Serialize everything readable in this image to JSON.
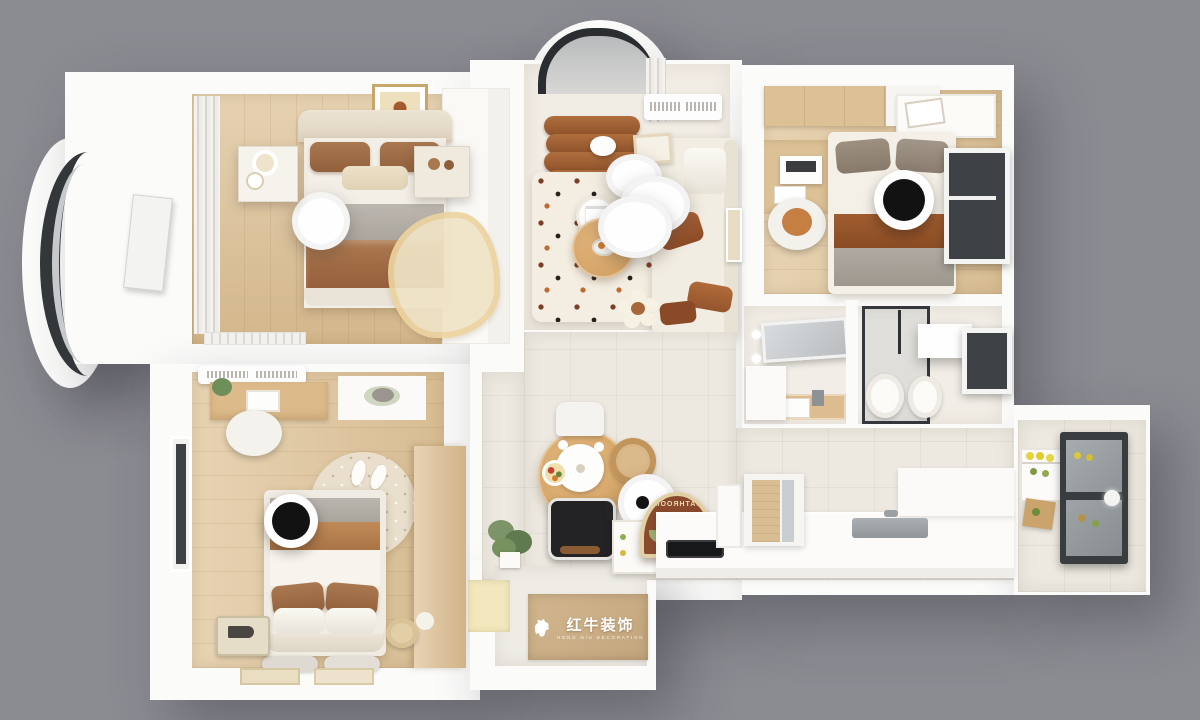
{
  "scene": {
    "type": "3d-apartment-floorplan-top-view",
    "background_color": "#8b8b92",
    "wall_color": "#fbfbfa"
  },
  "watermark": {
    "brand_cn": "红牛装饰",
    "brand_en": "HONG NIU DECORATION"
  },
  "bathroom_rug": {
    "text": "BATHROOM",
    "style": "mirrored arched rug with tulip motif",
    "colors": {
      "base": "#8a4a2e",
      "trim": "#e3cfa4",
      "tulip": "#e7c95e",
      "leaves": "#9aaa70"
    }
  },
  "palette": {
    "wood_floor": "#ddc298",
    "tile_floor": "#ede9e1",
    "living_floor": "#f1ece4",
    "sofa_cream": "#f2ede2",
    "armchair_brown": "#a05f34",
    "duvet_brown": "#a26e48",
    "runner_brown": "#96552c",
    "table_wood": "#d9a86c",
    "dark_frame": "#3a3d40",
    "lamp_black": "#151515"
  },
  "rooms": [
    {
      "name": "master-bedroom",
      "floor": "wood",
      "furniture": [
        "double-bed",
        "brown-pillows",
        "ceiling-lamp",
        "nightstand-left",
        "nightstand-right",
        "window-curtains",
        "ornate-accent-rug",
        "organic-bedside-rug",
        "radiator",
        "closet"
      ]
    },
    {
      "name": "bay-balcony",
      "floor": "white",
      "furniture": [
        "curved-glass-window",
        "leaning-board"
      ]
    },
    {
      "name": "living-room",
      "floor": "cream",
      "furniture": [
        "arched-bay-window",
        "sheer-curtain",
        "air-conditioner",
        "channel-tufted-armchair",
        "cloud-ceiling-lamp",
        "round-side-table",
        "round-coffee-table",
        "l-shaped-sofa",
        "polka-dot-rug",
        "flower-pouf",
        "leaning-frames"
      ]
    },
    {
      "name": "bedroom-2",
      "floor": "wood",
      "furniture": [
        "wardrobe-cabinets",
        "overbed-shelf",
        "desk",
        "laptop",
        "desk-chair",
        "single-bed",
        "brown-runner",
        "black-ring-ceiling-lamp",
        "window"
      ]
    },
    {
      "name": "bathroom",
      "floor": "tile",
      "furniture": [
        "vanity-mirror",
        "wash-basin-counter",
        "storage-cabinet",
        "glass-shower",
        "toilet",
        "bidet",
        "light-panel",
        "window"
      ]
    },
    {
      "name": "kitchen",
      "floor": "tile",
      "furniture": [
        "bottom-counter",
        "cooktop",
        "sink",
        "island-counter",
        "pantry-door",
        "tall-cabinet",
        "open-fridge",
        "food-shelves",
        "cutting-board",
        "window"
      ]
    },
    {
      "name": "dining-area",
      "floor": "tile",
      "furniture": [
        "round-wood-table",
        "bear-tray",
        "food-plate",
        "white-chair",
        "rattan-chair",
        "black-chair",
        "pendant-lamp",
        "potted-plant",
        "side-cabinet",
        "bathroom-rug-sign"
      ]
    },
    {
      "name": "bedroom-3",
      "floor": "wood",
      "furniture": [
        "air-conditioner",
        "desk",
        "desk-chair",
        "cat-on-cabinet",
        "round-speckled-rug",
        "slippers",
        "double-bed",
        "black-ring-ceiling-lamp",
        "floor-cushions",
        "wardrobe",
        "vintage-suitcase",
        "pouf",
        "door-mats",
        "window"
      ]
    },
    {
      "name": "entry-hall",
      "floor": "tile",
      "furniture": [
        "brand-doormat",
        "pale-yellow-mat"
      ]
    }
  ]
}
